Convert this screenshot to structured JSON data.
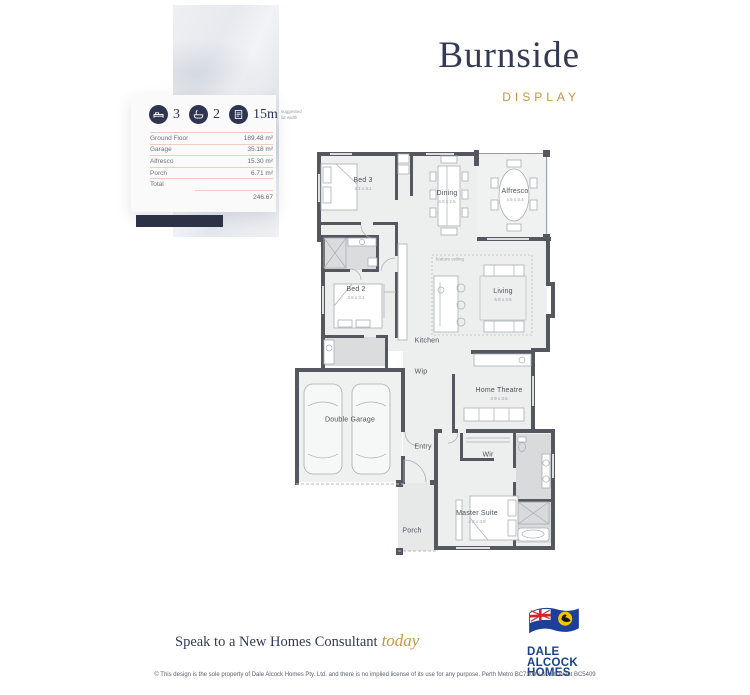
{
  "header": {
    "title": "Burnside",
    "subtitle": "DISPLAY"
  },
  "stats": {
    "beds": "3",
    "baths": "2",
    "frontage": "15m",
    "frontage_note": "suggested lot width",
    "icons": [
      "bed-icon",
      "bath-icon",
      "lot-width-icon"
    ]
  },
  "areas": {
    "rows": [
      {
        "label": "Ground Floor",
        "value": "189.48 m²"
      },
      {
        "label": "Garage",
        "value": "35.18 m²"
      },
      {
        "label": "Alfresco",
        "value": "15.30 m²"
      },
      {
        "label": "Porch",
        "value": "6.71 m²"
      }
    ],
    "total_label": "Total",
    "total_value": "246.67"
  },
  "floorplan": {
    "feature_label": "feature ceiling",
    "rooms": [
      {
        "name": "Bed 3",
        "dims": "4.1 x 3.1"
      },
      {
        "name": "Dining",
        "dims": "4.5 x 2.5"
      },
      {
        "name": "Alfresco",
        "dims": "4.5 x 3.4"
      },
      {
        "name": "Bed 2",
        "dims": "3.6 x 3.1"
      },
      {
        "name": "Living",
        "dims": "5.8 x 4.5"
      },
      {
        "name": "Kitchen"
      },
      {
        "name": "Wip"
      },
      {
        "name": "Home Theatre",
        "dims": "3.9 x 3.5"
      },
      {
        "name": "Double Garage"
      },
      {
        "name": "Entry"
      },
      {
        "name": "Wir"
      },
      {
        "name": "Master Suite",
        "dims": "4.2 x 3.9"
      },
      {
        "name": "Porch"
      }
    ]
  },
  "footer": {
    "cta_text": "Speak to a New Homes Consultant",
    "cta_script": "today",
    "logo": {
      "line1": "DALE",
      "line2": "ALCOCK",
      "line3": "HOMES"
    },
    "disclaimer": "© This design is the sole property of Dale Alcock Homes Pty. Ltd. and there is no implied license of its use for any purpose. Perth Metro BC7309 / South West BC5409"
  },
  "colors": {
    "navy": "#2f3550",
    "gold": "#c7953f",
    "wall": "#54585e",
    "table_line": "#f0cbc0",
    "flag_blue": "#1e3f97",
    "flag_yellow": "#f7c400"
  }
}
